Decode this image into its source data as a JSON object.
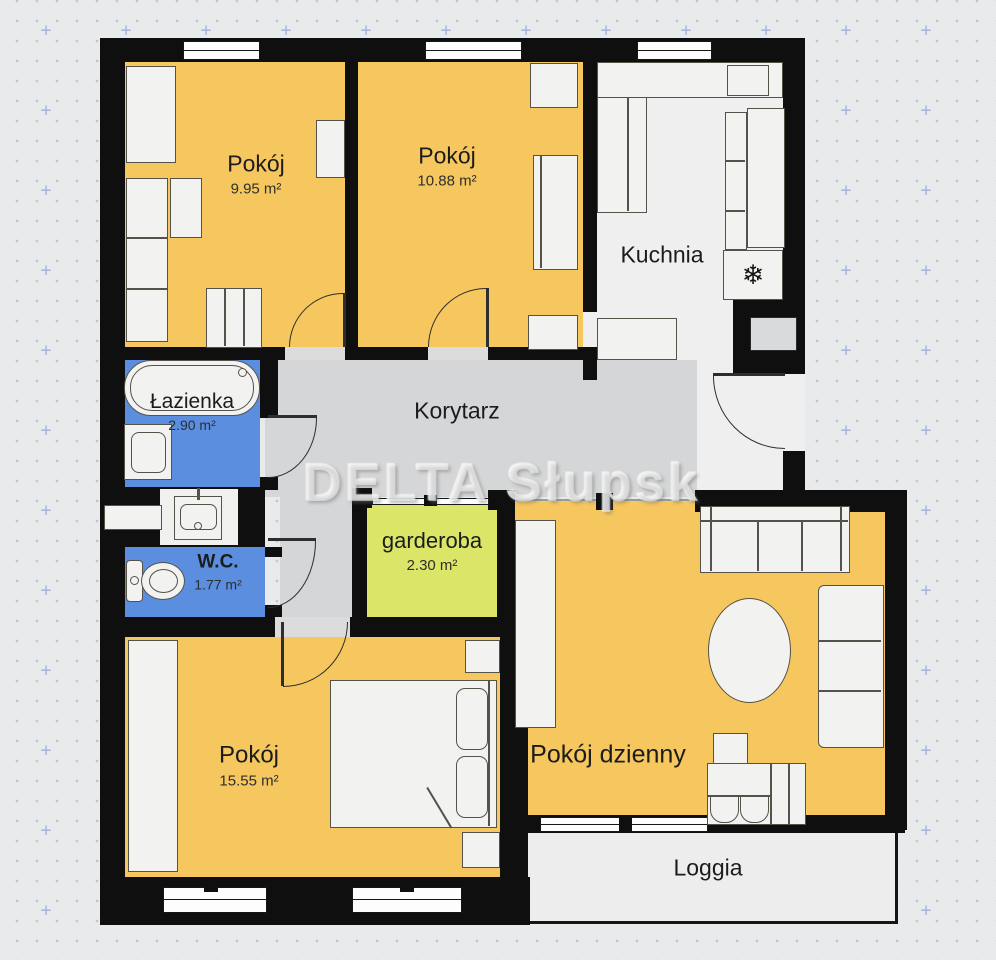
{
  "plan": {
    "watermark": "DELTA Słupsk",
    "rooms": {
      "room1": {
        "name": "Pokój",
        "area": "9.95 m²"
      },
      "room2": {
        "name": "Pokój",
        "area": "10.88 m²"
      },
      "kitchen": {
        "name": "Kuchnia"
      },
      "bathroom": {
        "name": "Łazienka",
        "area": "2.90 m²"
      },
      "corridor": {
        "name": "Korytarz"
      },
      "wc": {
        "name": "W.C.",
        "area": "1.77 m²"
      },
      "garderoba": {
        "name": "garderoba",
        "area": "2.30 m²"
      },
      "room3": {
        "name": "Pokój",
        "area": "15.55 m²"
      },
      "living": {
        "name": "Pokój dzienny"
      },
      "loggia": {
        "name": "Loggia"
      }
    },
    "icons": {
      "freezer_snowflake": "❄"
    },
    "colors": {
      "wall": "#0f0f0f",
      "room_fill": "#f6c75e",
      "wet_room_fill": "#5b8ede",
      "garderoba_fill": "#dbe567",
      "corridor_fill": "#d5d6d7",
      "kitchen_fill": "#efeff0",
      "background": "#e9eaeb",
      "grid_plus": "#94afda"
    }
  }
}
